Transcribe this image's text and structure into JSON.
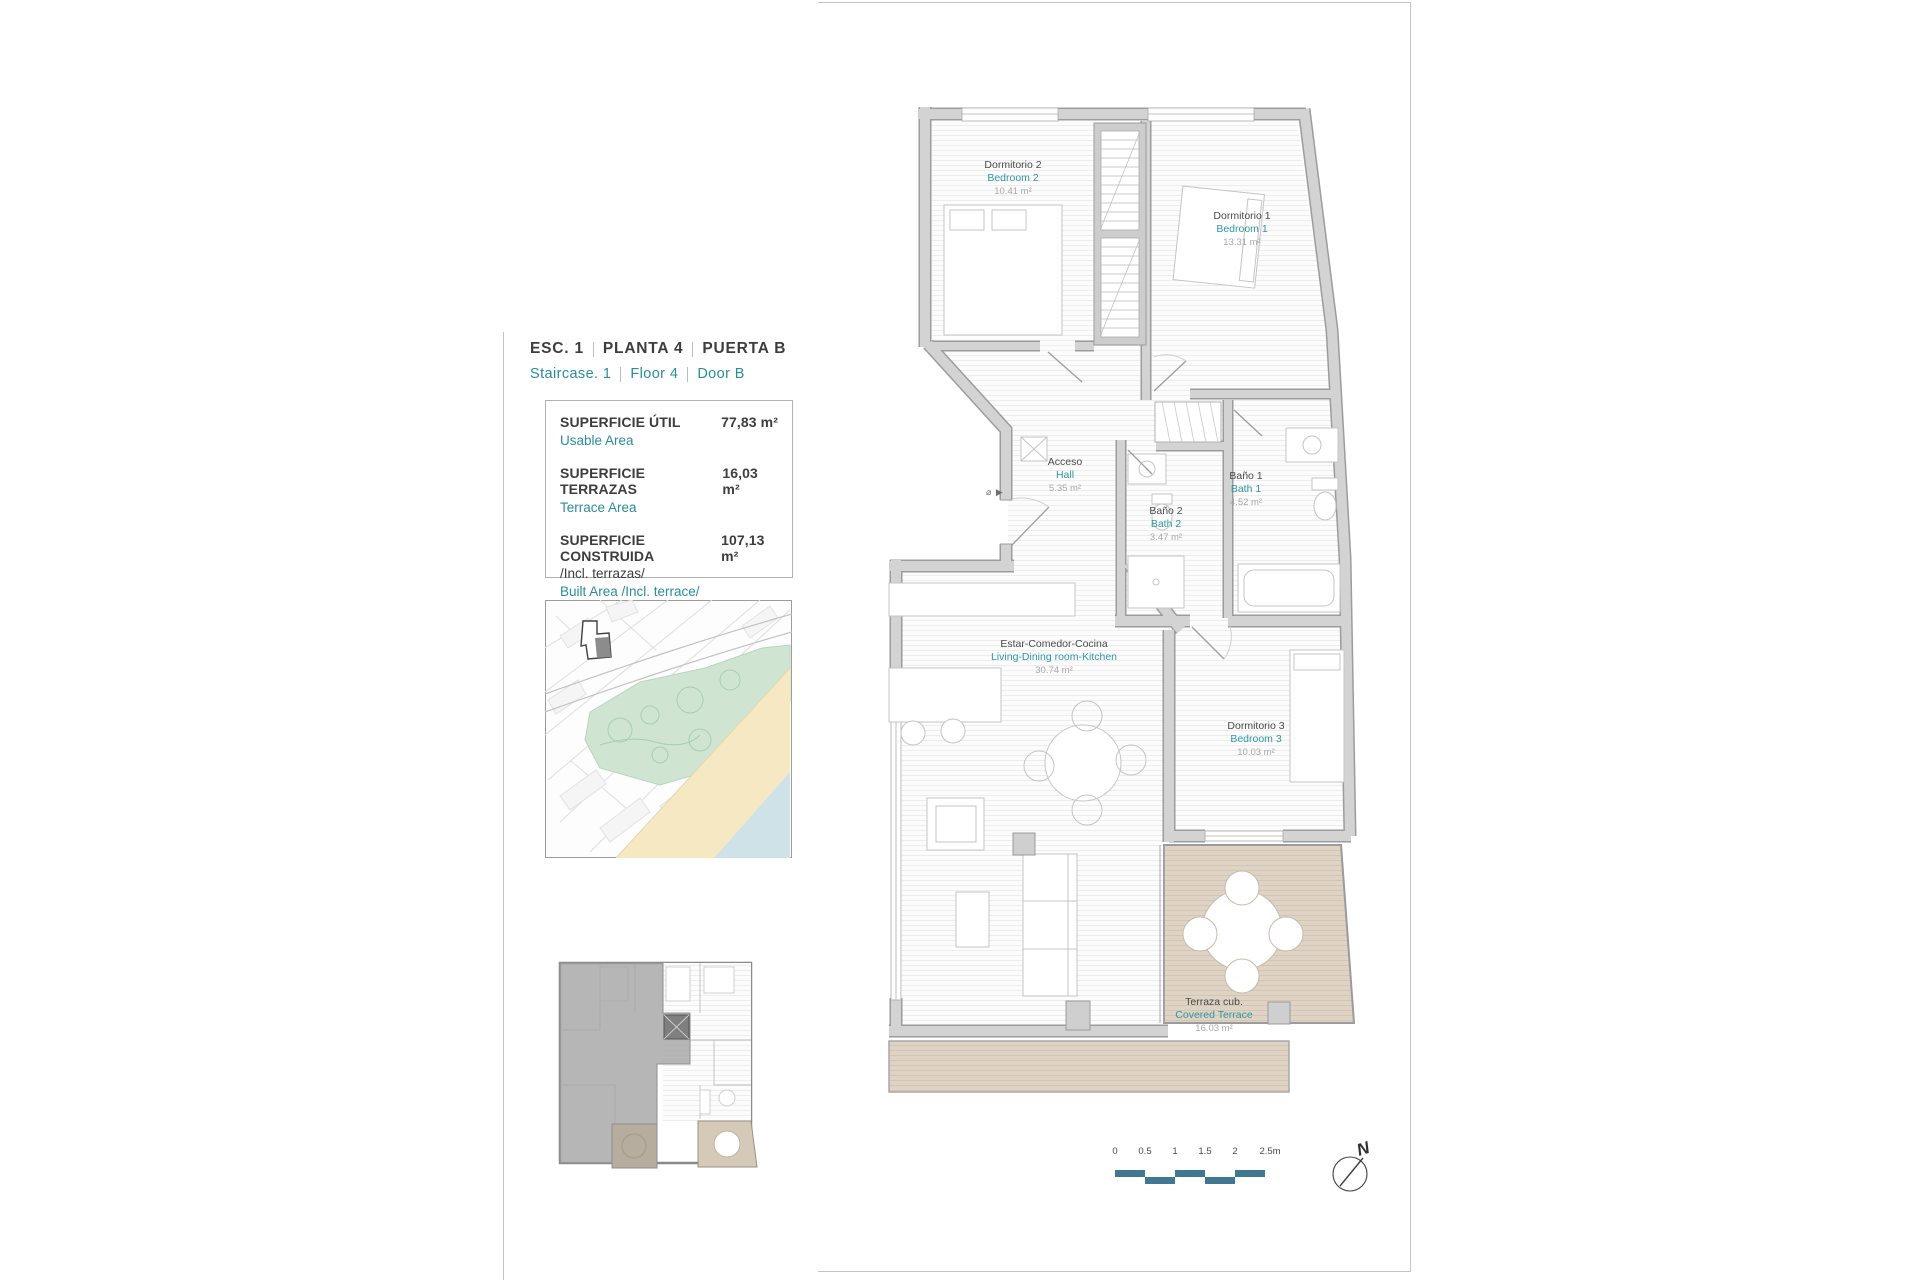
{
  "title_block": {
    "es_parts": [
      "ESC.  1",
      "PLANTA  4",
      "PUERTA  B"
    ],
    "en_parts": [
      "Staircase.  1",
      "Floor  4",
      "Door  B"
    ]
  },
  "areas": {
    "rows": [
      {
        "label_es": "SUPERFICIE ÚTIL",
        "value": "77,83 m²",
        "label_en": "Usable Area"
      },
      {
        "label_es": "SUPERFICIE TERRAZAS",
        "value": "16,03 m²",
        "label_en": "Terrace Area"
      },
      {
        "label_es": "SUPERFICIE CONSTRUIDA",
        "label_es_2": "/Incl. terrazas/",
        "value": "107,13 m²",
        "label_en": "Built Area /Incl. terrace/"
      }
    ]
  },
  "plan": {
    "rooms": [
      {
        "id": "bedroom2",
        "es": "Dormitorio 2",
        "en": "Bedroom 2",
        "area": "10.41 m²"
      },
      {
        "id": "bedroom1",
        "es": "Dormitorio 1",
        "en": "Bedroom 1",
        "area": "13.31 m²"
      },
      {
        "id": "hall",
        "es": "Acceso",
        "en": "Hall",
        "area": "5.35 m²"
      },
      {
        "id": "bath2",
        "es": "Baño 2",
        "en": "Bath 2",
        "area": "3.47 m²"
      },
      {
        "id": "bath1",
        "es": "Baño 1",
        "en": "Bath 1",
        "area": "4.52 m²"
      },
      {
        "id": "living",
        "es": "Estar-Comedor-Cocina",
        "en": "Living-Dining room-Kitchen",
        "area": "30.74 m²"
      },
      {
        "id": "bedroom3",
        "es": "Dormitorio 3",
        "en": "Bedroom 3",
        "area": "10.03 m²"
      },
      {
        "id": "terrace",
        "es": "Terraza cub.",
        "en": "Covered Terrace",
        "area": "16.03 m²"
      }
    ],
    "entry_marker": "⌀ ▶"
  },
  "scale_bar": {
    "labels": [
      "0",
      "0.5",
      "1",
      "1.5",
      "2",
      "2.5m"
    ]
  },
  "north": {
    "label": "N"
  },
  "colors": {
    "accent_teal": "#2b8c9c",
    "wall_gray": "#cdcdcd",
    "terrace_tan": "#ddd3c3",
    "scalebar_teal": "#3f7890",
    "map_green": "#cfe5d2",
    "map_sand": "#f6e8c2",
    "map_sea": "#cfe2e8"
  }
}
